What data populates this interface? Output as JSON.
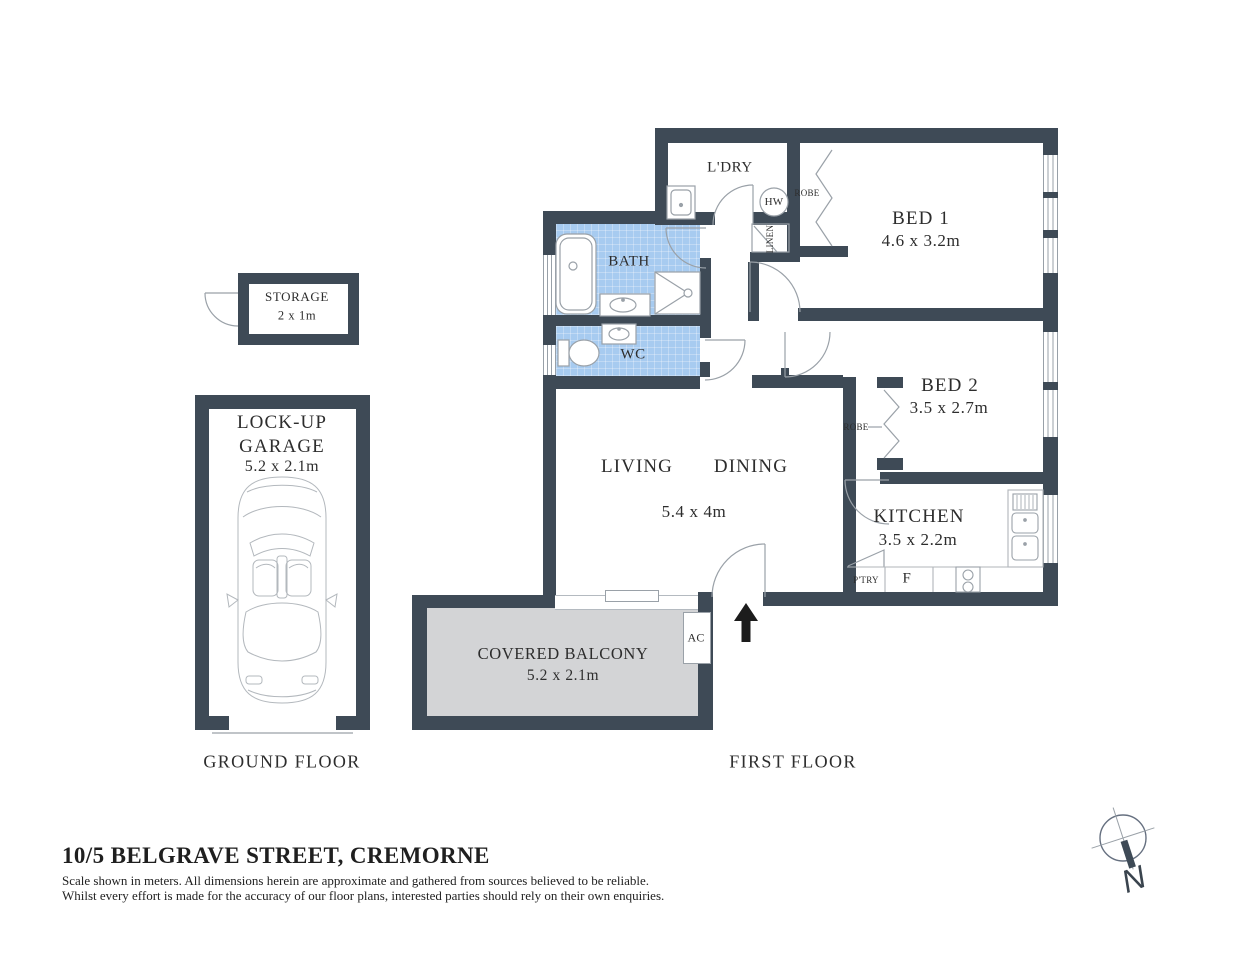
{
  "colors": {
    "wall": "#3e4a56",
    "wet_area_blue": "#a7cbf0",
    "balcony_grey": "#d3d4d6",
    "fixture_line_grey": "#9aa1a8",
    "text": "#2d2d2d"
  },
  "header": {
    "address": "10/5 BELGRAVE STREET, CREMORNE",
    "disclaimer1": "Scale shown in meters. All dimensions herein are approximate and gathered from sources believed to be  reliable.",
    "disclaimer2": "Whilst every effort is made for the accuracy of our floor plans, interested parties should rely on their own enquiries."
  },
  "floor_labels": {
    "ground": "GROUND FLOOR",
    "first": "FIRST FLOOR"
  },
  "rooms": {
    "laundry": "L'DRY",
    "hot_water": "HW",
    "robe1": "ROBE",
    "linen": "LINEN",
    "bed1_name": "BED 1",
    "bed1_dims": "4.6 x 3.2m",
    "bath": "BATH",
    "wc": "WC",
    "bed2_name": "BED 2",
    "bed2_dims": "3.5 x 2.7m",
    "robe2": "ROBE",
    "living": "LIVING",
    "dining": "DINING",
    "living_dims": "5.4 x 4m",
    "kitchen_name": "KITCHEN",
    "kitchen_dims": "3.5 x 2.2m",
    "pantry": "P'TRY",
    "fridge": "F",
    "ac": "AC",
    "balcony_name": "COVERED BALCONY",
    "balcony_dims": "5.2 x 2.1m",
    "storage_name": "STORAGE",
    "storage_dims": "2 x 1m",
    "garage_line1": "LOCK-UP",
    "garage_line2": "GARAGE",
    "garage_dims": "5.2 x 2.1m"
  },
  "compass": {
    "north": "N"
  }
}
